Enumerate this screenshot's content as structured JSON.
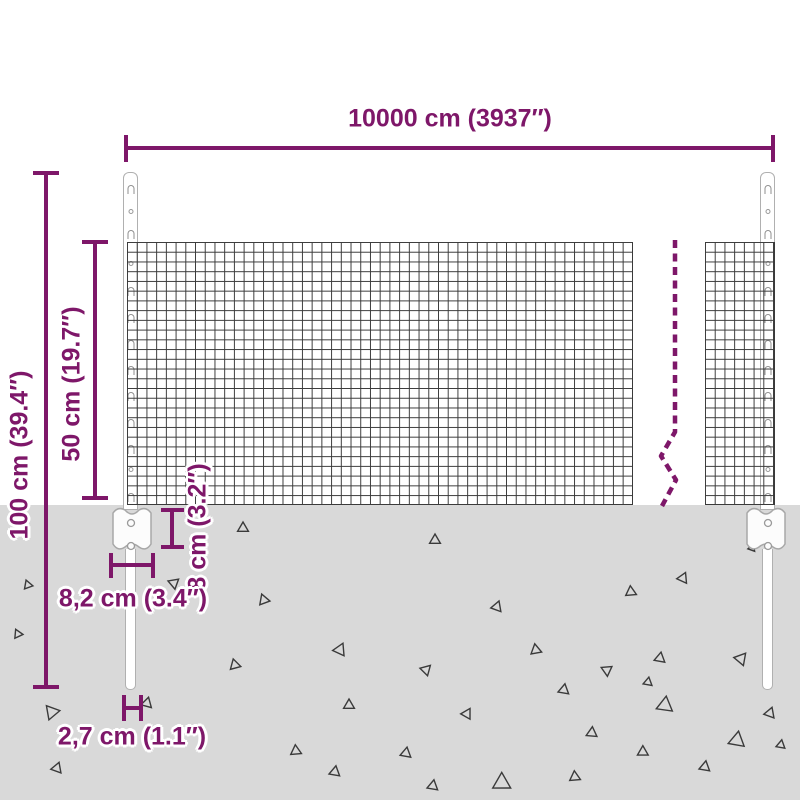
{
  "diagram": {
    "accent_color": "#7e1769",
    "ground_color": "#d9d9d9",
    "mesh_line_color": "#3a3a3a",
    "post_outline_color": "#b0b0b0"
  },
  "dimensions": {
    "total_width": {
      "label": "10000 cm (3937″)",
      "value_cm": "10000",
      "value_in": "3937"
    },
    "total_height": {
      "label": "100 cm (39.4″)",
      "value_cm": "100",
      "value_in": "39.4"
    },
    "mesh_height": {
      "label": "50 cm (19.7″)",
      "value_cm": "50",
      "value_in": "19.7"
    },
    "anchor_depth": {
      "label": "8 cm (3.2″)",
      "value_cm": "8",
      "value_in": "3.2"
    },
    "anchor_plate_width": {
      "label": "8,2 cm (3.4″)",
      "value_cm": "8,2",
      "value_in": "3.4"
    },
    "post_width": {
      "label": "2,7 cm (1.1″)",
      "value_cm": "2,7",
      "value_in": "1.1"
    }
  },
  "decorations": {
    "post_clip_marks": [
      {
        "y": 12,
        "t": "slot"
      },
      {
        "y": 36,
        "t": "hole"
      },
      {
        "y": 57,
        "t": "slot"
      },
      {
        "y": 88,
        "t": "hole"
      },
      {
        "y": 114,
        "t": "slot"
      },
      {
        "y": 141,
        "t": "slot"
      },
      {
        "y": 167,
        "t": "slot"
      },
      {
        "y": 193,
        "t": "slot"
      },
      {
        "y": 219,
        "t": "slot"
      },
      {
        "y": 246,
        "t": "slot"
      },
      {
        "y": 272,
        "t": "slot"
      },
      {
        "y": 294,
        "t": "hole"
      },
      {
        "y": 320,
        "t": "slot"
      }
    ],
    "debris_triangles": [
      {
        "x": 243,
        "y": 528,
        "s": 6,
        "r": 0
      },
      {
        "x": 435,
        "y": 540,
        "s": 6,
        "r": 0
      },
      {
        "x": 174,
        "y": 583,
        "s": 6,
        "r": 50
      },
      {
        "x": 28,
        "y": 585,
        "s": 5,
        "r": 100
      },
      {
        "x": 264,
        "y": 600,
        "s": 6,
        "r": 100
      },
      {
        "x": 497,
        "y": 607,
        "s": 6,
        "r": 140
      },
      {
        "x": 631,
        "y": 592,
        "s": 6,
        "r": 115
      },
      {
        "x": 683,
        "y": 578,
        "s": 6,
        "r": 25
      },
      {
        "x": 18,
        "y": 634,
        "s": 5,
        "r": 95
      },
      {
        "x": 340,
        "y": 650,
        "s": 7,
        "r": 145
      },
      {
        "x": 235,
        "y": 665,
        "s": 6,
        "r": 105
      },
      {
        "x": 426,
        "y": 670,
        "s": 6,
        "r": 165
      },
      {
        "x": 536,
        "y": 650,
        "s": 6,
        "r": 110
      },
      {
        "x": 607,
        "y": 670,
        "s": 6,
        "r": 55
      },
      {
        "x": 564,
        "y": 690,
        "s": 6,
        "r": 130
      },
      {
        "x": 660,
        "y": 658,
        "s": 6,
        "r": 10
      },
      {
        "x": 665,
        "y": 705,
        "s": 9,
        "r": 8
      },
      {
        "x": 648,
        "y": 682,
        "s": 5,
        "r": 10
      },
      {
        "x": 741,
        "y": 659,
        "s": 7,
        "r": 160
      },
      {
        "x": 770,
        "y": 713,
        "s": 6,
        "r": 20
      },
      {
        "x": 349,
        "y": 705,
        "s": 6,
        "r": 0
      },
      {
        "x": 467,
        "y": 714,
        "s": 6,
        "r": 150
      },
      {
        "x": 52,
        "y": 712,
        "s": 8,
        "r": 80
      },
      {
        "x": 147,
        "y": 703,
        "s": 6,
        "r": 15
      },
      {
        "x": 296,
        "y": 751,
        "s": 6,
        "r": 115
      },
      {
        "x": 406,
        "y": 753,
        "s": 6,
        "r": 10
      },
      {
        "x": 592,
        "y": 733,
        "s": 6,
        "r": 125
      },
      {
        "x": 737,
        "y": 740,
        "s": 9,
        "r": 10
      },
      {
        "x": 643,
        "y": 752,
        "s": 6,
        "r": 120
      },
      {
        "x": 705,
        "y": 767,
        "s": 6,
        "r": 130
      },
      {
        "x": 575,
        "y": 777,
        "s": 6,
        "r": 115
      },
      {
        "x": 433,
        "y": 786,
        "s": 6,
        "r": 130
      },
      {
        "x": 502,
        "y": 783,
        "s": 10,
        "r": 120
      },
      {
        "x": 335,
        "y": 772,
        "s": 6,
        "r": 130
      },
      {
        "x": 57,
        "y": 768,
        "s": 6,
        "r": 20
      },
      {
        "x": 781,
        "y": 745,
        "s": 5,
        "r": 130
      },
      {
        "x": 752,
        "y": 548,
        "s": 4,
        "r": 20
      }
    ]
  }
}
